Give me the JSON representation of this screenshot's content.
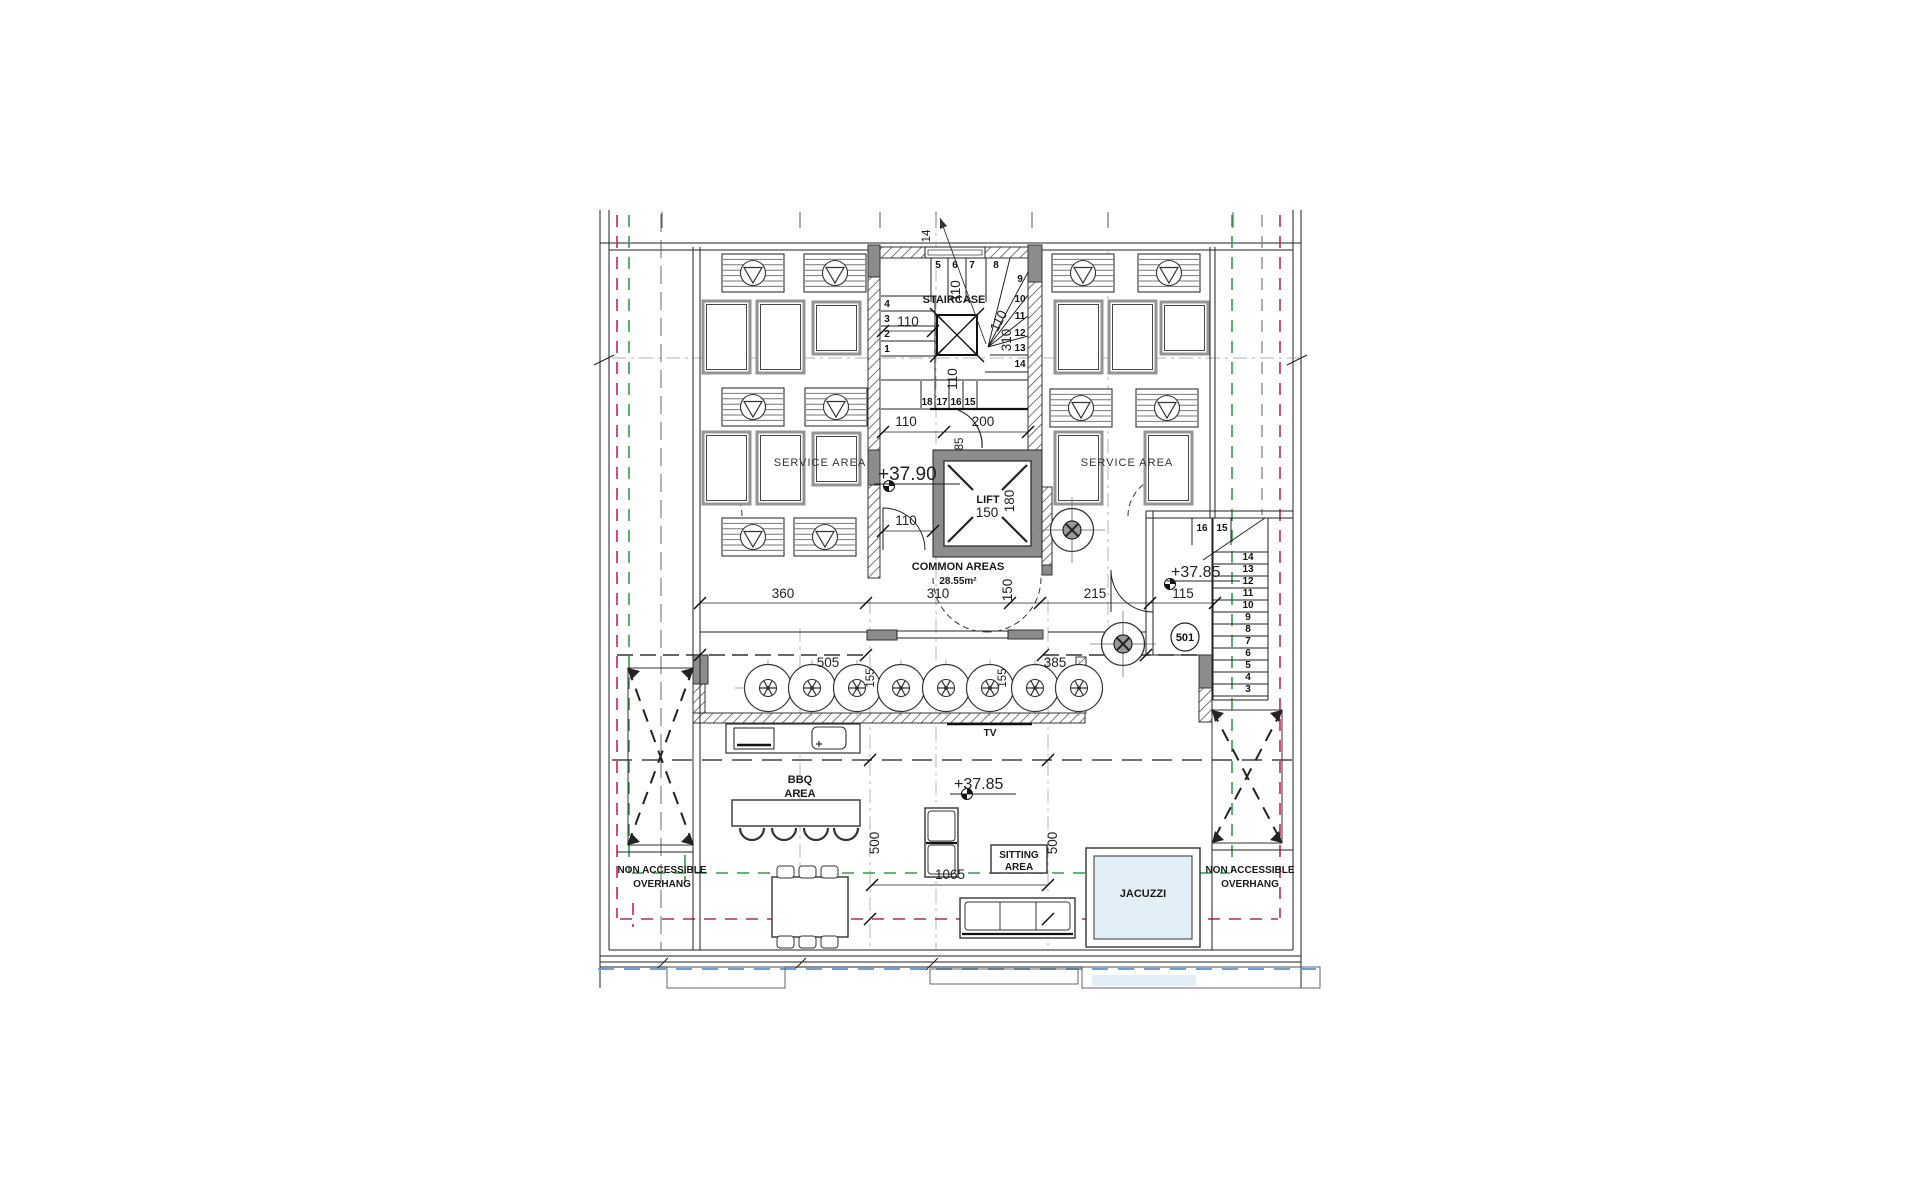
{
  "colors": {
    "line": "#222222",
    "wall_fill": "#8c8c8c",
    "hatch": "#555555",
    "setback_red": "#c2255c",
    "setback_green": "#2f9e44",
    "slab_blue": "#6a9fd8",
    "pool_fill": "#e3eff7"
  },
  "core": {
    "staircase_label": "STAIRCASE",
    "lift_label": "LIFT",
    "common_label": "COMMON AREAS",
    "common_area_value": "28.55m²",
    "steps": [
      "1",
      "2",
      "3",
      "4",
      "5",
      "6",
      "7",
      "8",
      "9",
      "10",
      "11",
      "12",
      "13",
      "14",
      "15",
      "16",
      "17",
      "18"
    ],
    "dims": {
      "top_width": "14",
      "flight_left": "110",
      "flight_top": "110",
      "winder": "110",
      "stair_length": "310",
      "mid_width": "110",
      "below_stair": "110",
      "door_opening": "200",
      "jamb": "85",
      "corridor": "110",
      "lift_width": "150",
      "lift_depth": "180"
    }
  },
  "service": {
    "left_label": "SERVICE AREA",
    "right_label": "SERVICE AREA"
  },
  "levels": {
    "service_roof": "+37.90",
    "terrace": "+37.85",
    "entry": "+37.85"
  },
  "dims_mid": {
    "left": "360",
    "core": "310",
    "lift_side": "150",
    "entry_side": "215",
    "porch": "115"
  },
  "dims_planter": {
    "left": "505",
    "depth_left": "155",
    "depth_right": "155",
    "right": "385"
  },
  "terrace": {
    "bbq_line1": "BBQ",
    "bbq_line2": "AREA",
    "tv_label": "TV",
    "sitting_line1": "SITTING",
    "sitting_line2": "AREA",
    "jacuzzi_label": "JACUZZI",
    "width": "1065",
    "depth_left": "500",
    "depth_right": "500"
  },
  "overhang": {
    "line1": "NON ACCESSIBLE",
    "line2": "OVERHANG"
  },
  "entry": {
    "unit": "501",
    "steps": [
      "3",
      "4",
      "5",
      "6",
      "7",
      "8",
      "9",
      "10",
      "11",
      "12",
      "13",
      "14",
      "15",
      "16"
    ]
  }
}
